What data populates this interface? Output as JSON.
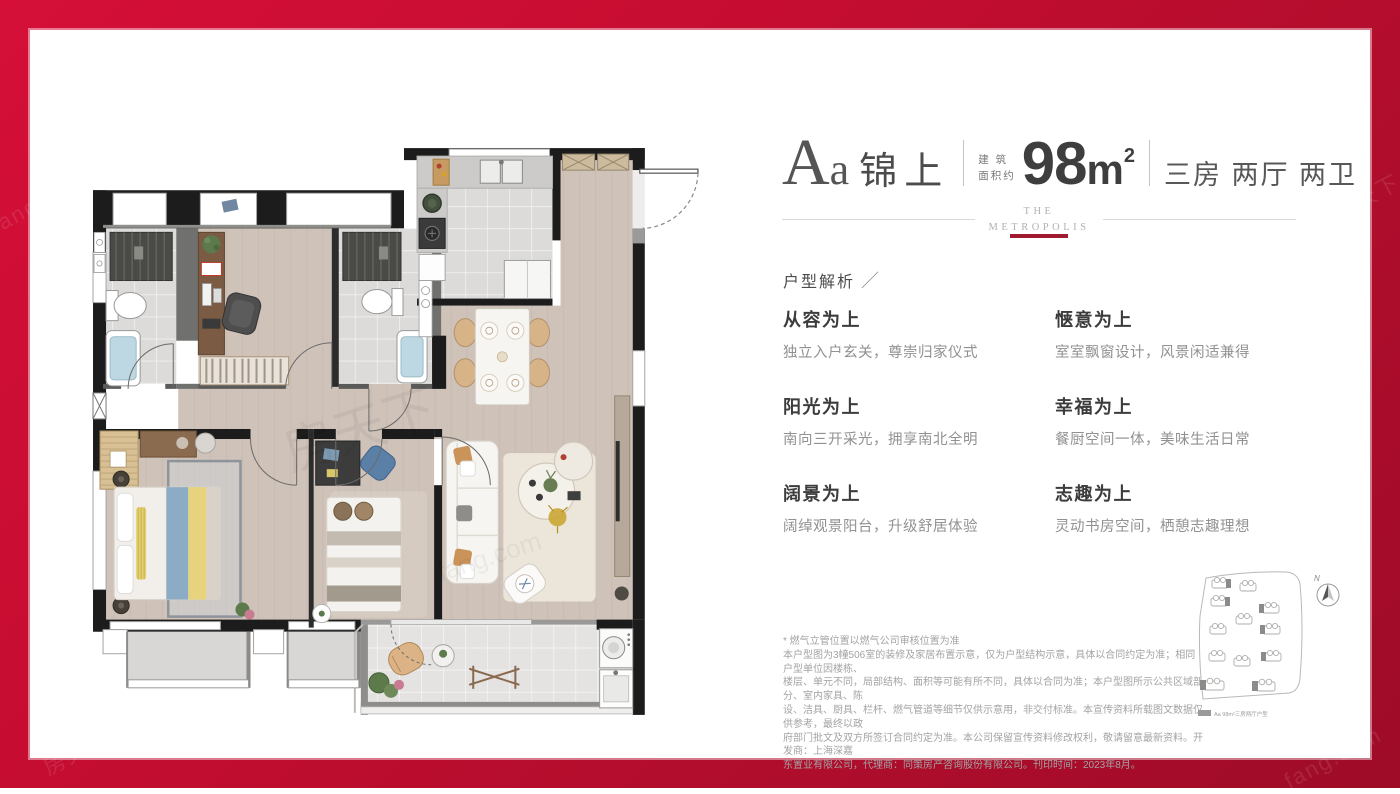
{
  "page": {
    "watermark_cn": "房天下",
    "watermark_en": "fang.com",
    "colors": {
      "frame_red": "#c60d31",
      "accent_red": "#a01a30"
    }
  },
  "header": {
    "unit_letter_big": "A",
    "unit_letter_small": "a",
    "unit_name": "锦上",
    "area_label_top": "建 筑",
    "area_label_bottom": "面积约",
    "area_value": "98",
    "area_unit": "m",
    "area_exponent": "2",
    "rooms": "三房 两厅 两卫",
    "brand_line1": "THE",
    "brand_line2": "METROPOLIS"
  },
  "analysis": {
    "title": "户型解析",
    "slash": "／"
  },
  "features": [
    {
      "title": "从容为上",
      "desc": "独立入户玄关，尊崇归家仪式"
    },
    {
      "title": "惬意为上",
      "desc": "室室飘窗设计，风景闲适兼得"
    },
    {
      "title": "阳光为上",
      "desc": "南向三开采光，拥享南北全明"
    },
    {
      "title": "幸福为上",
      "desc": "餐厨空间一体，美味生活日常"
    },
    {
      "title": "阔景为上",
      "desc": "阔绰观景阳台，升级舒居体验"
    },
    {
      "title": "志趣为上",
      "desc": "灵动书房空间，栖憩志趣理想"
    }
  ],
  "disclaimer": {
    "lines": [
      "* 燃气立管位置以燃气公司审核位置为准",
      "本户型图为3幢506室的装修及家居布置示意，仅为户型结构示意，具体以合同约定为准；相同户型单位因楼栋、",
      "楼层、单元不同，局部结构、面积等可能有所不同，具体以合同为准；本户型图所示公共区域部分、室内家具、陈",
      "设、洁具、厨具、栏杆、燃气管道等细节仅供示意用，非交付标准。本宣传资料所载图文数据仅供参考，最终以政",
      "府部门批文及双方所签订合同约定为准。本公司保留宣传资料修改权利，敬请留意最新资料。开发商：上海深嘉",
      "东置业有限公司，代理商：同策房产咨询股份有限公司。刊印时间：2023年8月。"
    ]
  },
  "sitemap": {
    "north_label": "N",
    "legend": "Aa 98m²三房两厅户型"
  }
}
